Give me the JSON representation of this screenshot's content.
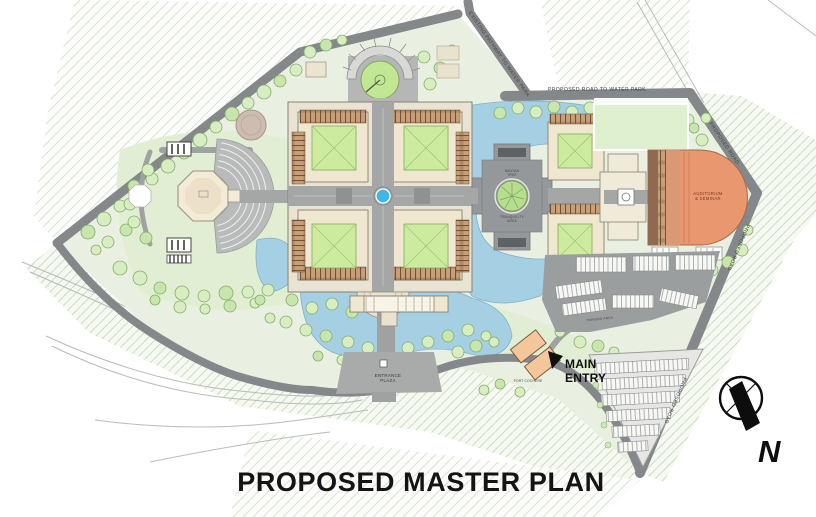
{
  "title": "PROPOSED MASTER PLAN",
  "compass": {
    "north_label": "N"
  },
  "roads": {
    "proposed_road_to_water_park": "PROPOSED ROAD TO WATER PARK",
    "existing_pathway_to_water_park": "EXISTING PATHWAY TO WATER PARK",
    "proposed_road": "PROPOSED ROAD"
  },
  "labels": {
    "banyan_tree": "BANYAN\nTREE",
    "tranquility_area": "TRANQUILITY\nAREA",
    "auditorium": "AUDITORIUM\n& SEMINAR",
    "entrance_plaza": "ENTRANCE\nPLAZA",
    "main_entry": "MAIN\nENTRY",
    "port_cochere": "PORT COCHERE",
    "parking_area": "PARKING AREA"
  },
  "colors": {
    "site_green": "#e9f0e1",
    "patch_green": "#e0edd2",
    "water_blue": "#a5d0e4",
    "road_gray": "#85888b",
    "plaza_gray": "#a4a7a6",
    "building_cream": "#efe7d0",
    "courtyard_green": "#cdeb9f",
    "colonnade_brown": "#c99f77",
    "auditorium_orange": "#e8976e",
    "entry_gate_orange": "#f3c79b",
    "title_black": "#141414"
  }
}
